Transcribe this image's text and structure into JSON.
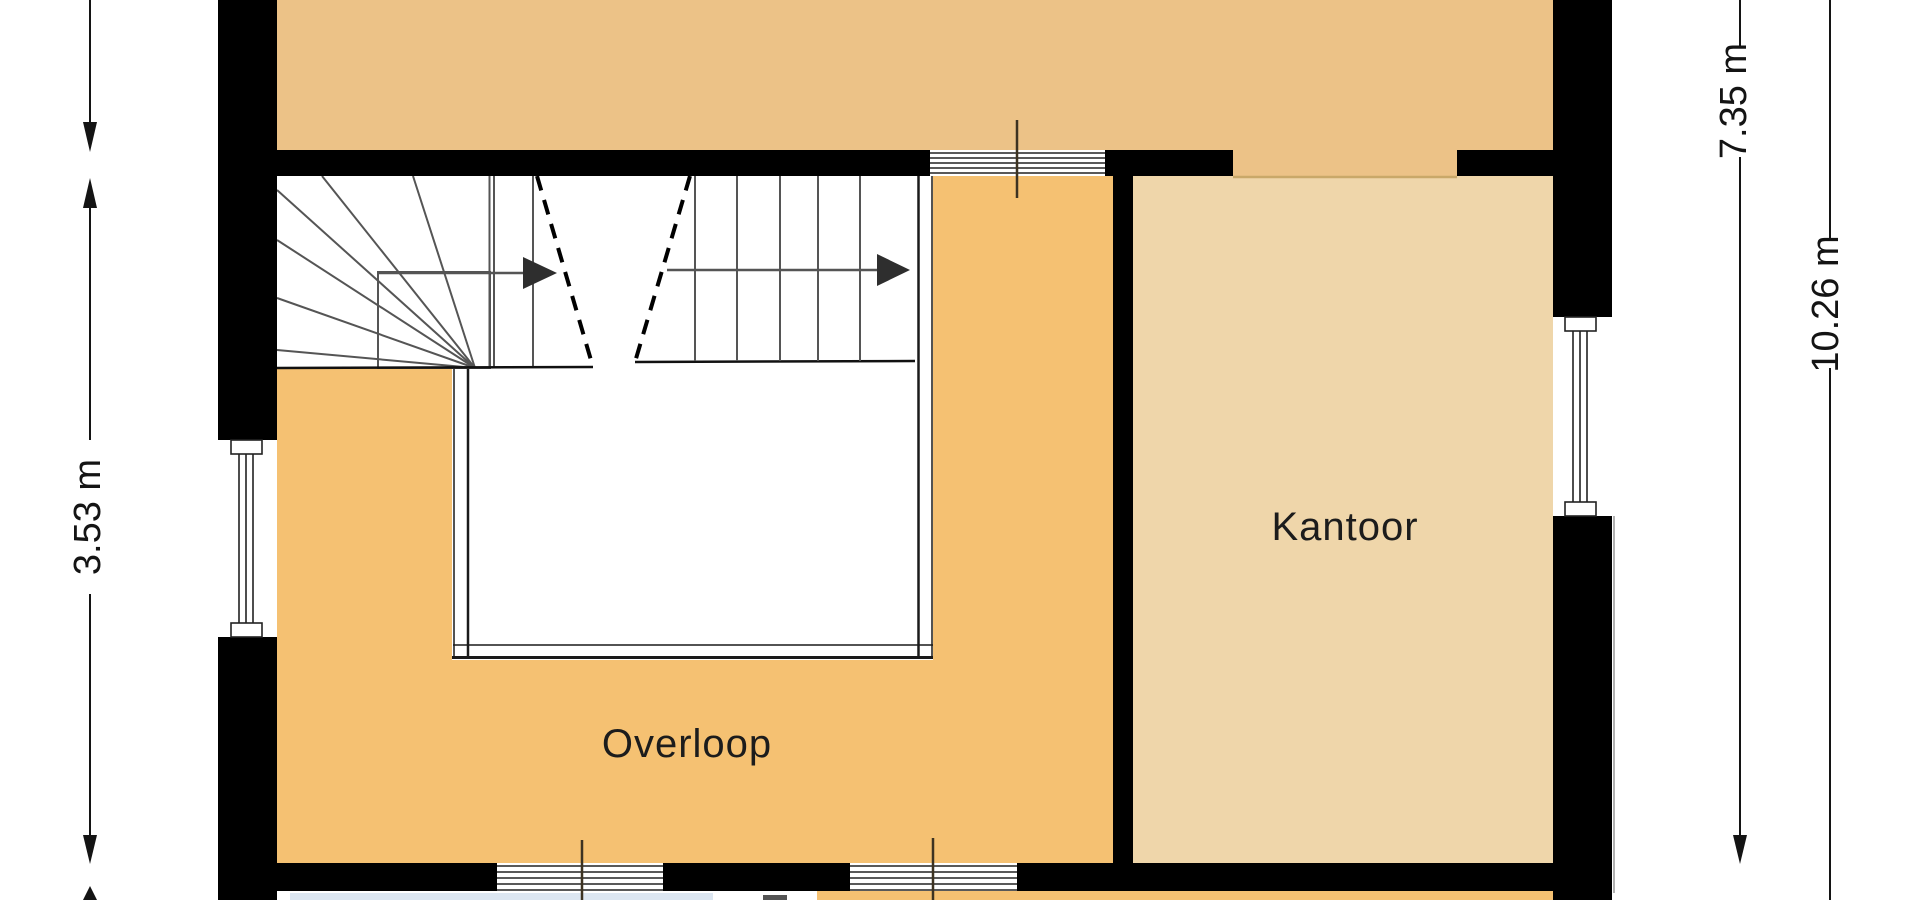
{
  "plan": {
    "type": "floorplan-view",
    "rooms": [
      {
        "name": "Overloop"
      },
      {
        "name": "Kantoor"
      }
    ],
    "dimensions": [
      {
        "label": "3.53 m",
        "side": "left",
        "orientation": "vertical"
      },
      {
        "label": "7.35 m",
        "side": "right-inner",
        "orientation": "vertical"
      },
      {
        "label": "10.26 m",
        "side": "right-outer",
        "orientation": "vertical"
      }
    ],
    "icons": [
      {
        "name": "stair-direction-arrow-left-flight",
        "glyph": "filled right-pointing triangle"
      },
      {
        "name": "stair-direction-arrow-right-flight",
        "glyph": "filled right-pointing triangle"
      },
      {
        "name": "dimension-arrowheads",
        "glyph": "filled triangles at dimension line ends"
      }
    ],
    "colors": {
      "wall": "#000000",
      "room_top": "#ECC287",
      "room_overloop": "#F5C172",
      "room_kantoor": "#EFD6AA",
      "below_floor_blue": "#DCE6F1",
      "stair_line": "#555555",
      "dimension_line": "#141414",
      "window_line": "#222222",
      "threshold": "#C9A869"
    }
  }
}
